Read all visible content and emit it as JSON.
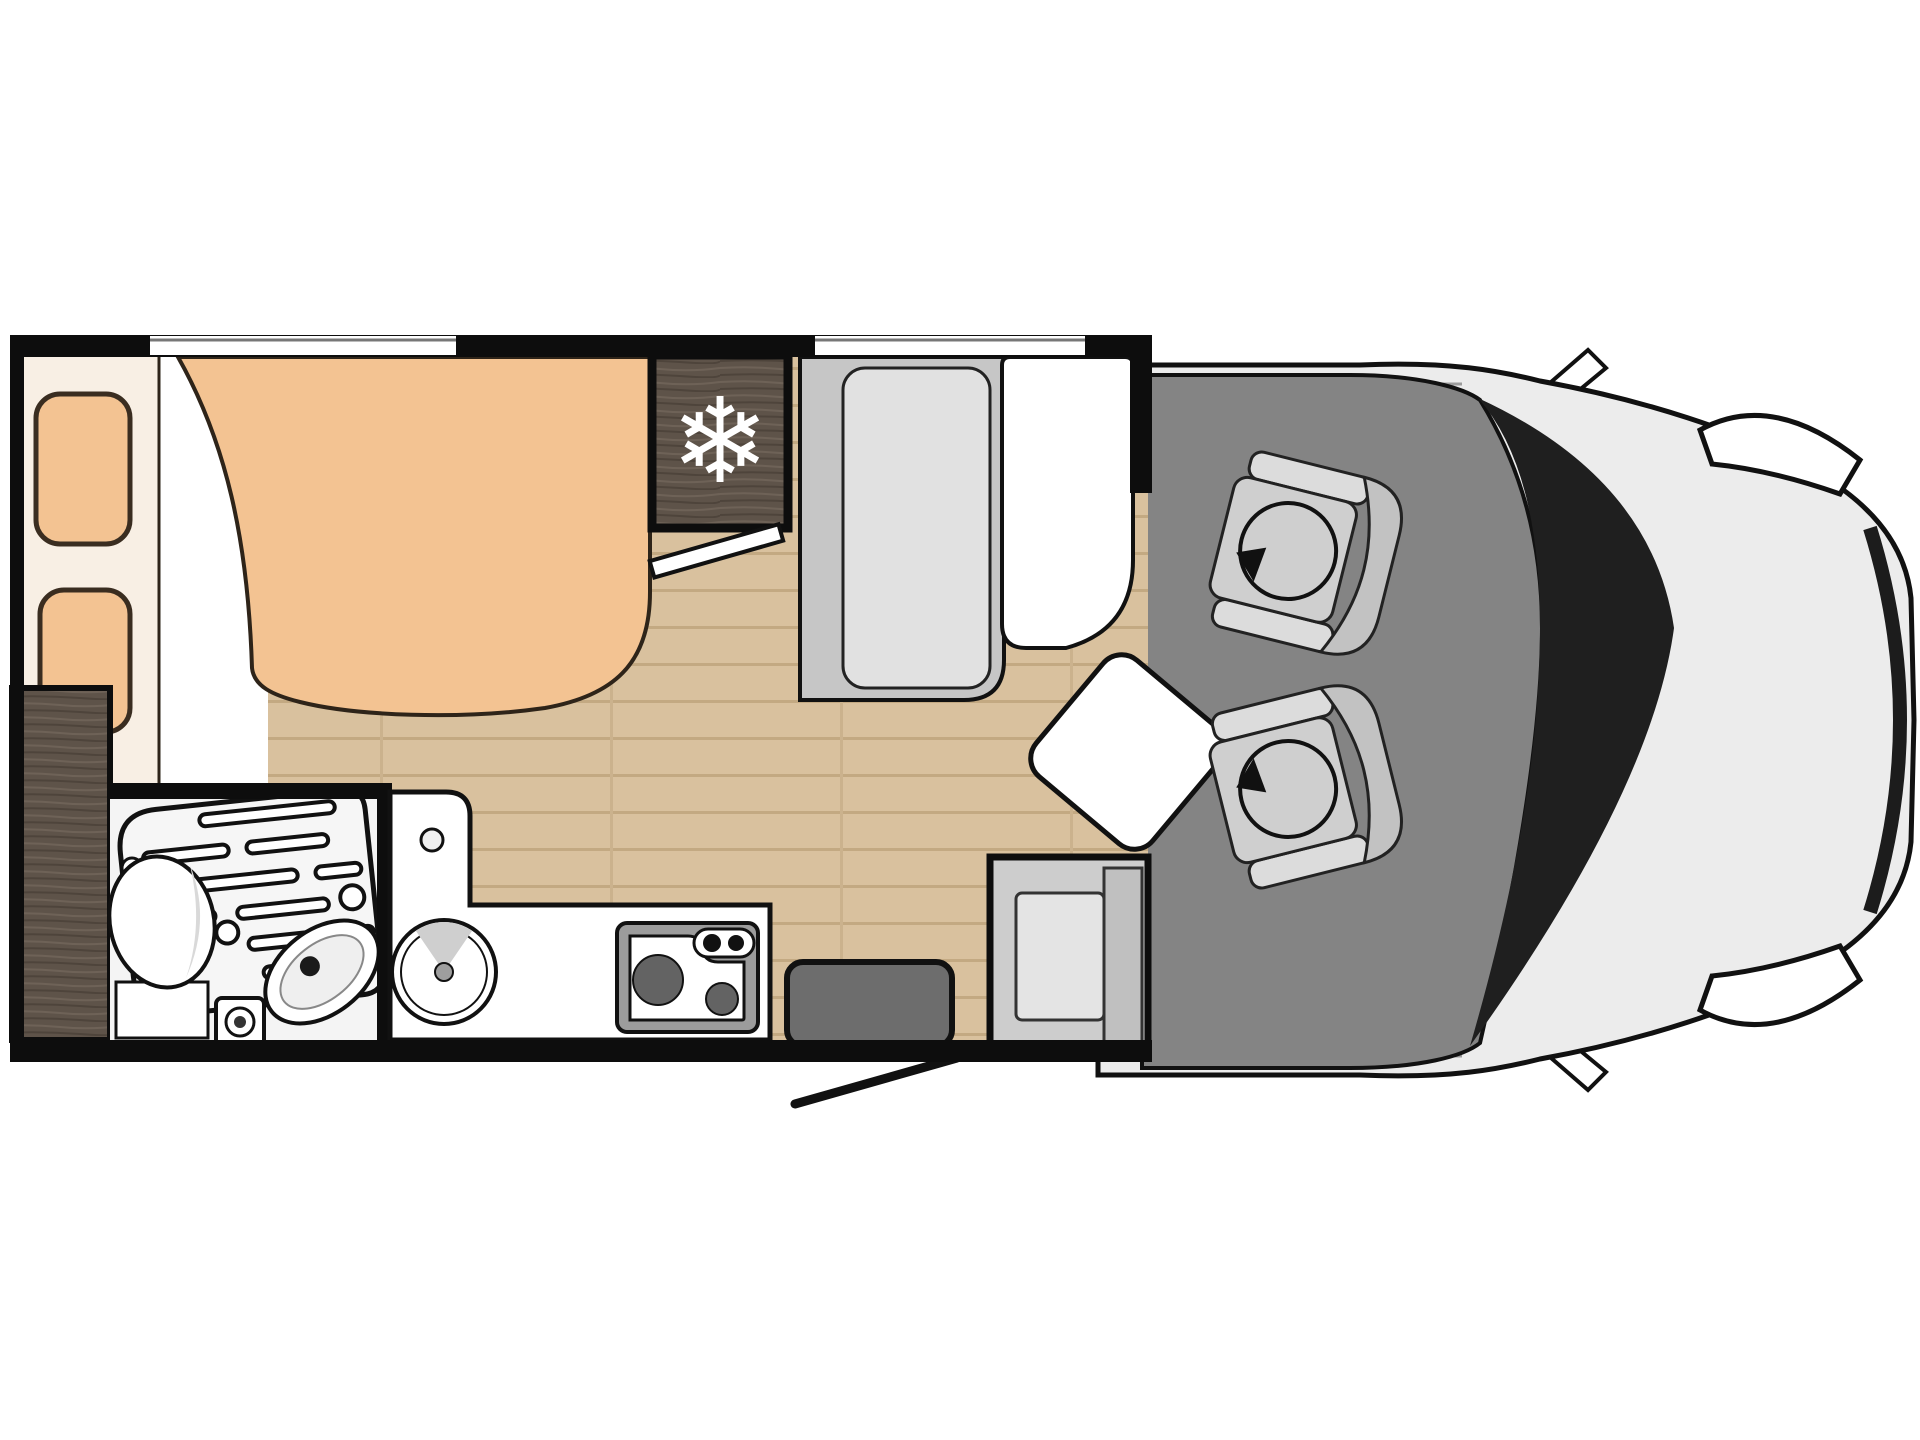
{
  "page": {
    "title": "Motorhome floor plan – top view",
    "background": "#ffffff"
  },
  "icons": {
    "snowflake_glyph": "❄",
    "snowflake_meaning": "refrigerator",
    "swivel_arrow_meaning": "rotating cab seat"
  },
  "colors": {
    "wall": "#0d0d0d",
    "outline": "#111111",
    "mattress": "#f3c392",
    "window": "#f3c392",
    "window_frame": "#3a2d20",
    "headboard": "#f8efe4",
    "bed_deck": "#ffffff",
    "wood_light": "#d9c19e",
    "wood_plank_line": "#c3a982",
    "wood_dark": "#5e5349",
    "wood_dark_streak": "#6e6257",
    "bathroom_floor": "#f4f4f4",
    "cab_floor": "#848484",
    "van_body": "#ececec",
    "windshield": "#1f1f1f",
    "bench": "#c6c6c6",
    "bench_panel": "#e1e1e1",
    "cushion": "#ffffff",
    "table": "#ffffff",
    "seat_base": "#cfcfcf",
    "seat_part": "#dcdcdc",
    "seat_back": "#c2c2c2",
    "entry_step": "#6d6d6d",
    "cabinet": "#cdcdcd",
    "cabinet_panel": "#e4e4e4",
    "cabinet_strip": "#c0c0c0",
    "fixture_white": "#ffffff",
    "stove_frame": "#9c9c9c",
    "burner": "#636363",
    "sink_shade": "#cfcfcf"
  },
  "plan": {
    "view": "top-down",
    "vehicle": "semi-integrated motorhome",
    "zones": [
      {
        "id": "bedroom",
        "feature": "french-bed-with-two-wall-windows"
      },
      {
        "id": "bathroom",
        "feature": "shower-toilet-washbasin"
      },
      {
        "id": "wardrobe",
        "feature": "dark-wood-cabinet-strip"
      },
      {
        "id": "kitchen",
        "feature": "round-sink-two-burner-hob"
      },
      {
        "id": "fridge",
        "feature": "refrigerator-with-snowflake"
      },
      {
        "id": "dinette",
        "feature": "bench-seat-cushion-and-table"
      },
      {
        "id": "entry",
        "feature": "entrance-step-and-open-door"
      },
      {
        "id": "cab",
        "feature": "two-swivel-seats-windshield-hood-mirrors-headlights"
      }
    ]
  }
}
